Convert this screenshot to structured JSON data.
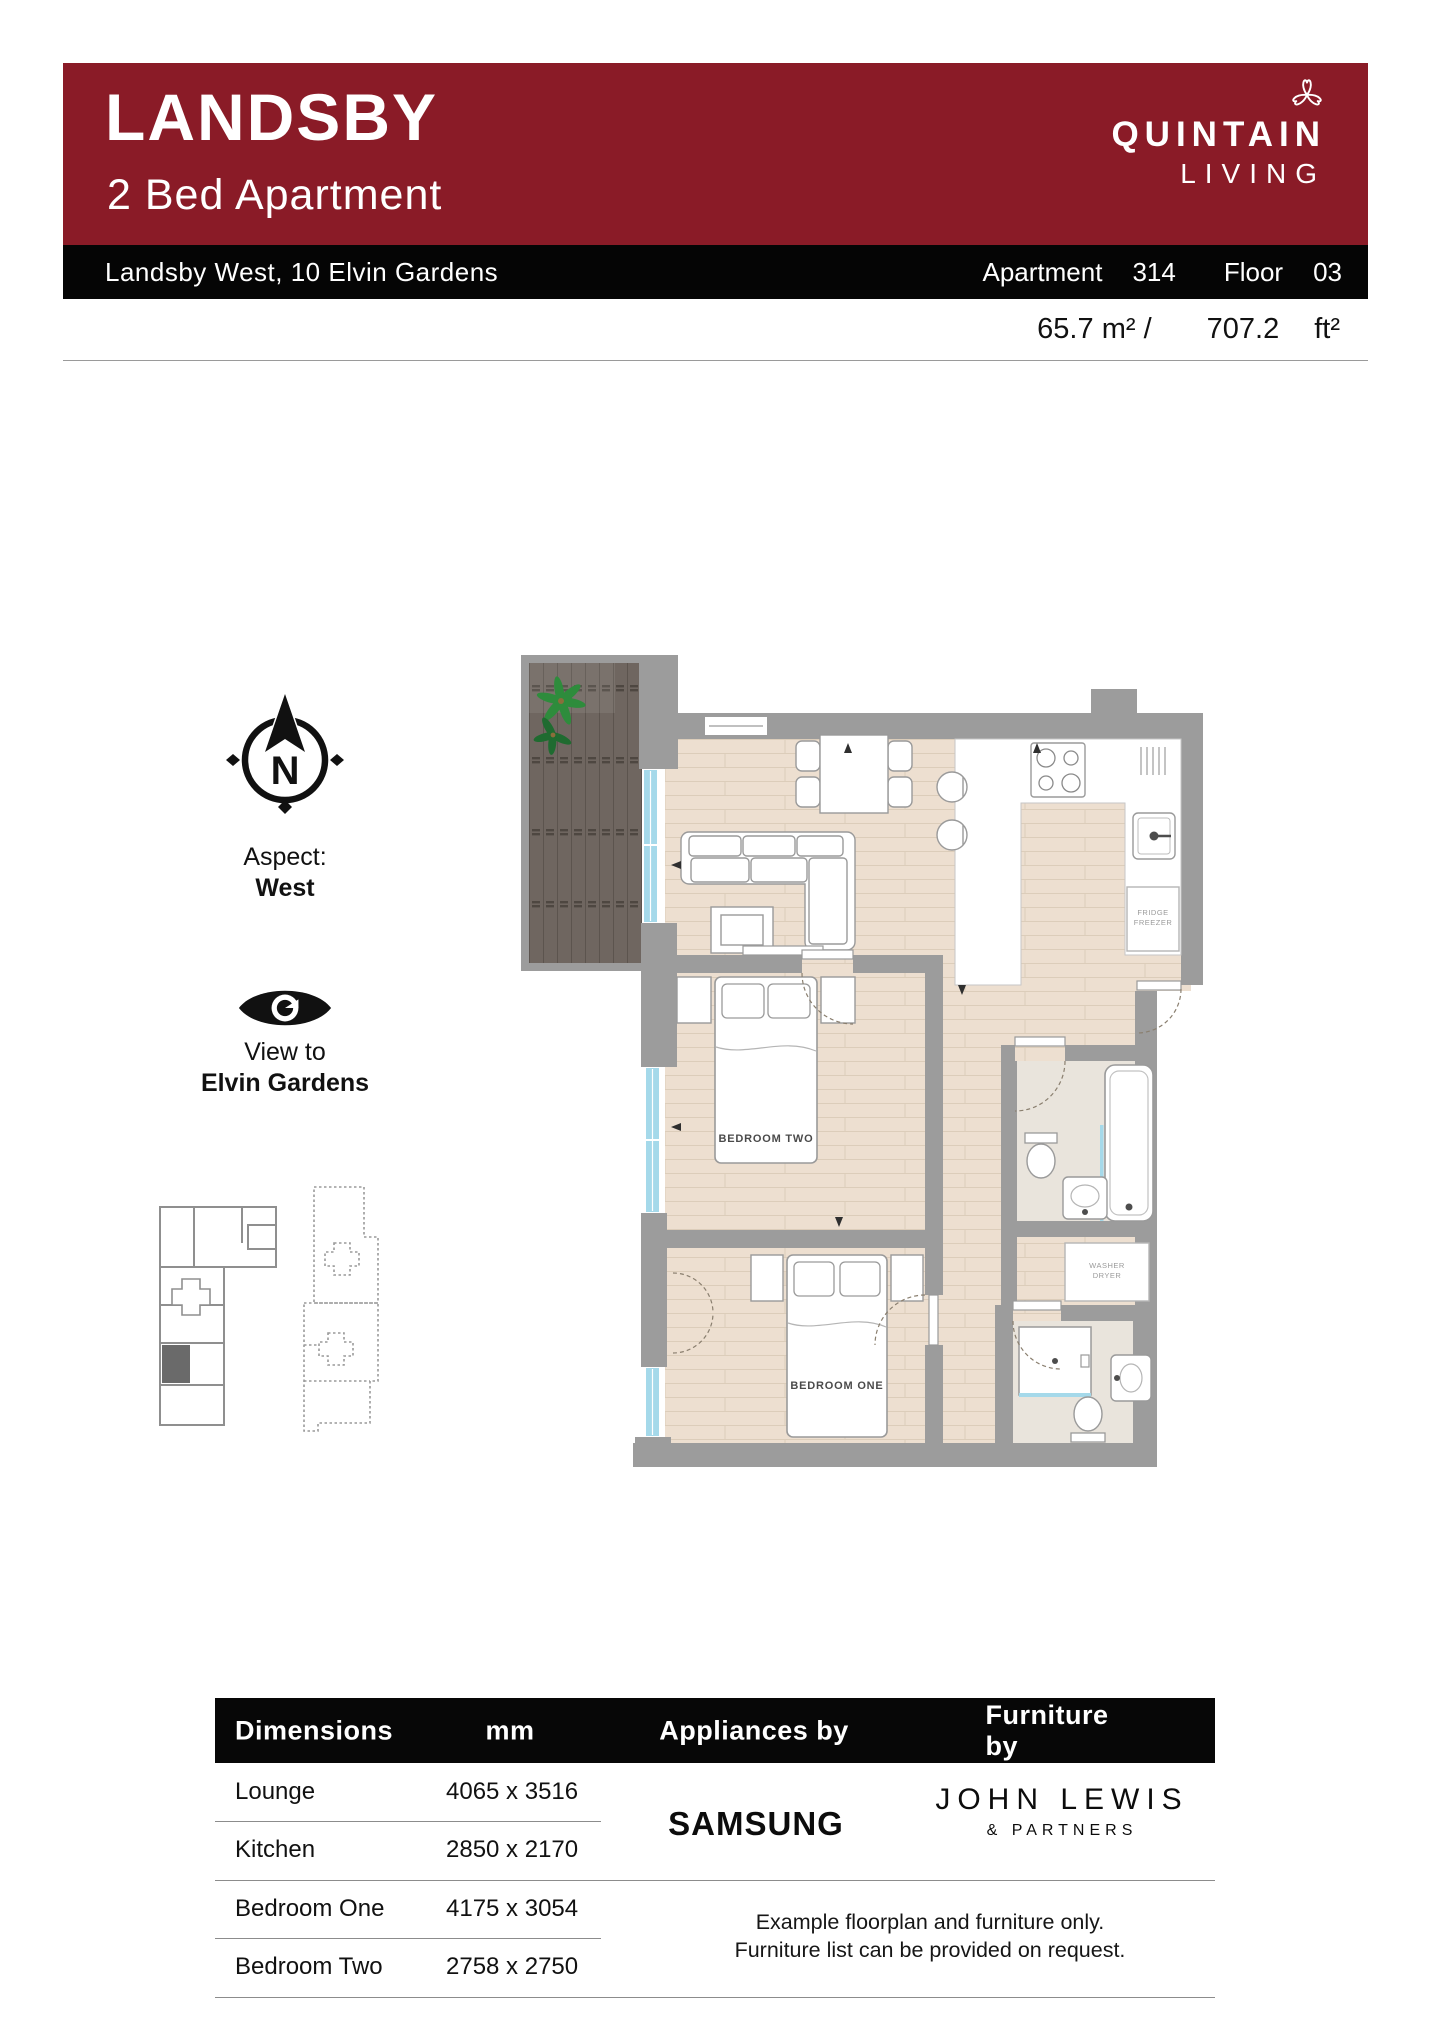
{
  "header": {
    "project": "LANDSBY",
    "subtitle": "2 Bed Apartment",
    "brand_line1": "QUINTAIN",
    "brand_line2": "LIVING",
    "accent_color": "#8A1B27"
  },
  "address_bar": {
    "address": "Landsby West, 10 Elvin Gardens",
    "apartment_label": "Apartment",
    "apartment_value": "314",
    "floor_label": "Floor",
    "floor_value": "03"
  },
  "area": {
    "metric_value": "65.7",
    "metric_unit": "m²",
    "divider": "/",
    "imperial_value": "707.2",
    "imperial_unit": "ft²"
  },
  "aspect": {
    "compass_letter": "N",
    "label": "Aspect:",
    "value": "West"
  },
  "view": {
    "label": "View to",
    "value": "Elvin Gardens"
  },
  "floorplan": {
    "bedroom_one_label": "BEDROOM ONE",
    "bedroom_two_label": "BEDROOM TWO",
    "fridge_line1": "FRIDGE",
    "fridge_line2": "FREEZER",
    "washer_line1": "WASHER",
    "washer_line2": "DRYER",
    "colors": {
      "wall": "#9C9C9C",
      "wood_floor": "#EDDFD0",
      "tile_floor": "#E9E4DC",
      "deck": "#6F6660",
      "window": "#A5D9EA"
    }
  },
  "table": {
    "headers": {
      "dimensions": "Dimensions",
      "unit": "mm",
      "appliances": "Appliances by",
      "furniture": "Furniture by"
    },
    "rows": [
      {
        "room": "Lounge",
        "size": "4065 x 3516"
      },
      {
        "room": "Kitchen",
        "size": "2850 x 2170"
      },
      {
        "room": "Bedroom One",
        "size": "4175 x 3054"
      },
      {
        "room": "Bedroom Two",
        "size": "2758 x 2750"
      }
    ],
    "appliances_brand": "SAMSUNG",
    "furniture_brand_line1": "JOHN LEWIS",
    "furniture_brand_line2": "& PARTNERS",
    "disclaimer_line1": "Example floorplan and furniture only.",
    "disclaimer_line2": "Furniture list can be provided on request."
  }
}
